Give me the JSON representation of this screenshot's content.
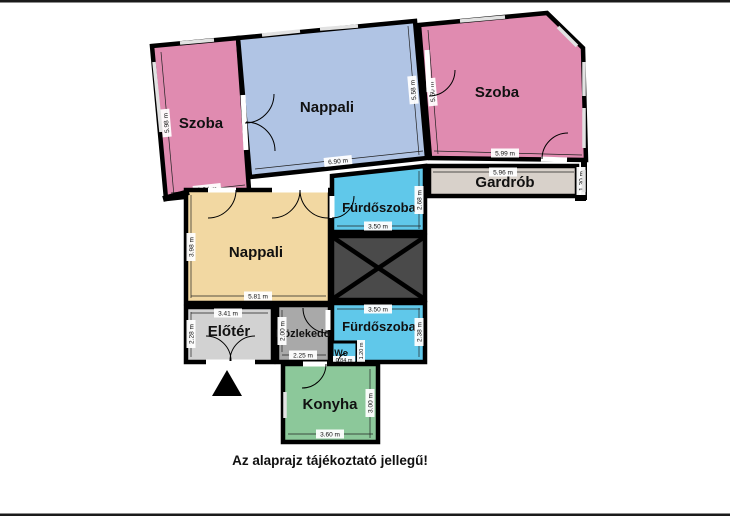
{
  "note": "Az alaprajz tájékoztató jellegű!",
  "colors": {
    "room_pink": "#e08bb0",
    "room_blue": "#b0c4e4",
    "room_cyan": "#60c8ea",
    "room_tan": "#f2d8a2",
    "room_green": "#8cc89a",
    "room_gray_light": "#d2d2d2",
    "room_gray_mid": "#a9a9a9",
    "room_beige": "#d8d1ca",
    "shaft_dark": "#4a4a4a",
    "wall": "#000000"
  },
  "rooms": [
    {
      "id": "szoba-left",
      "label": "Szoba",
      "dims": [
        "5.98 m",
        "3.24 m"
      ]
    },
    {
      "id": "nappali-top",
      "label": "Nappali",
      "dims": [
        "6.90 m",
        "5.58 m"
      ]
    },
    {
      "id": "szoba-right",
      "label": "Szoba",
      "dims": [
        "5.60 m",
        "5.99 m"
      ]
    },
    {
      "id": "gardrob",
      "label": "Gardrób",
      "dims": [
        "5.96 m",
        "1.30 m"
      ]
    },
    {
      "id": "furdoszoba-top",
      "label": "Fürdőszoba",
      "dims": [
        "3.50 m",
        "2.68 m"
      ]
    },
    {
      "id": "nappali-middle",
      "label": "Nappali",
      "dims": [
        "5.81 m",
        "3.98 m"
      ]
    },
    {
      "id": "eloter",
      "label": "Előtér",
      "dims": [
        "3.41 m",
        "2.28 m"
      ]
    },
    {
      "id": "kozlekedo",
      "label": "Közlekedő",
      "dims": [
        "2.25 m",
        "2.00 m"
      ]
    },
    {
      "id": "furdoszoba-bottom",
      "label": "Fürdőszoba",
      "dims": [
        "3.50 m",
        "2.38 m"
      ]
    },
    {
      "id": "wc",
      "label": "Wc",
      "dims": [
        "0.84 m",
        "1.20 m"
      ]
    },
    {
      "id": "konyha",
      "label": "Konyha",
      "dims": [
        "3.60 m",
        "3.00 m"
      ]
    },
    {
      "id": "shaft",
      "label": "",
      "dims": []
    }
  ]
}
